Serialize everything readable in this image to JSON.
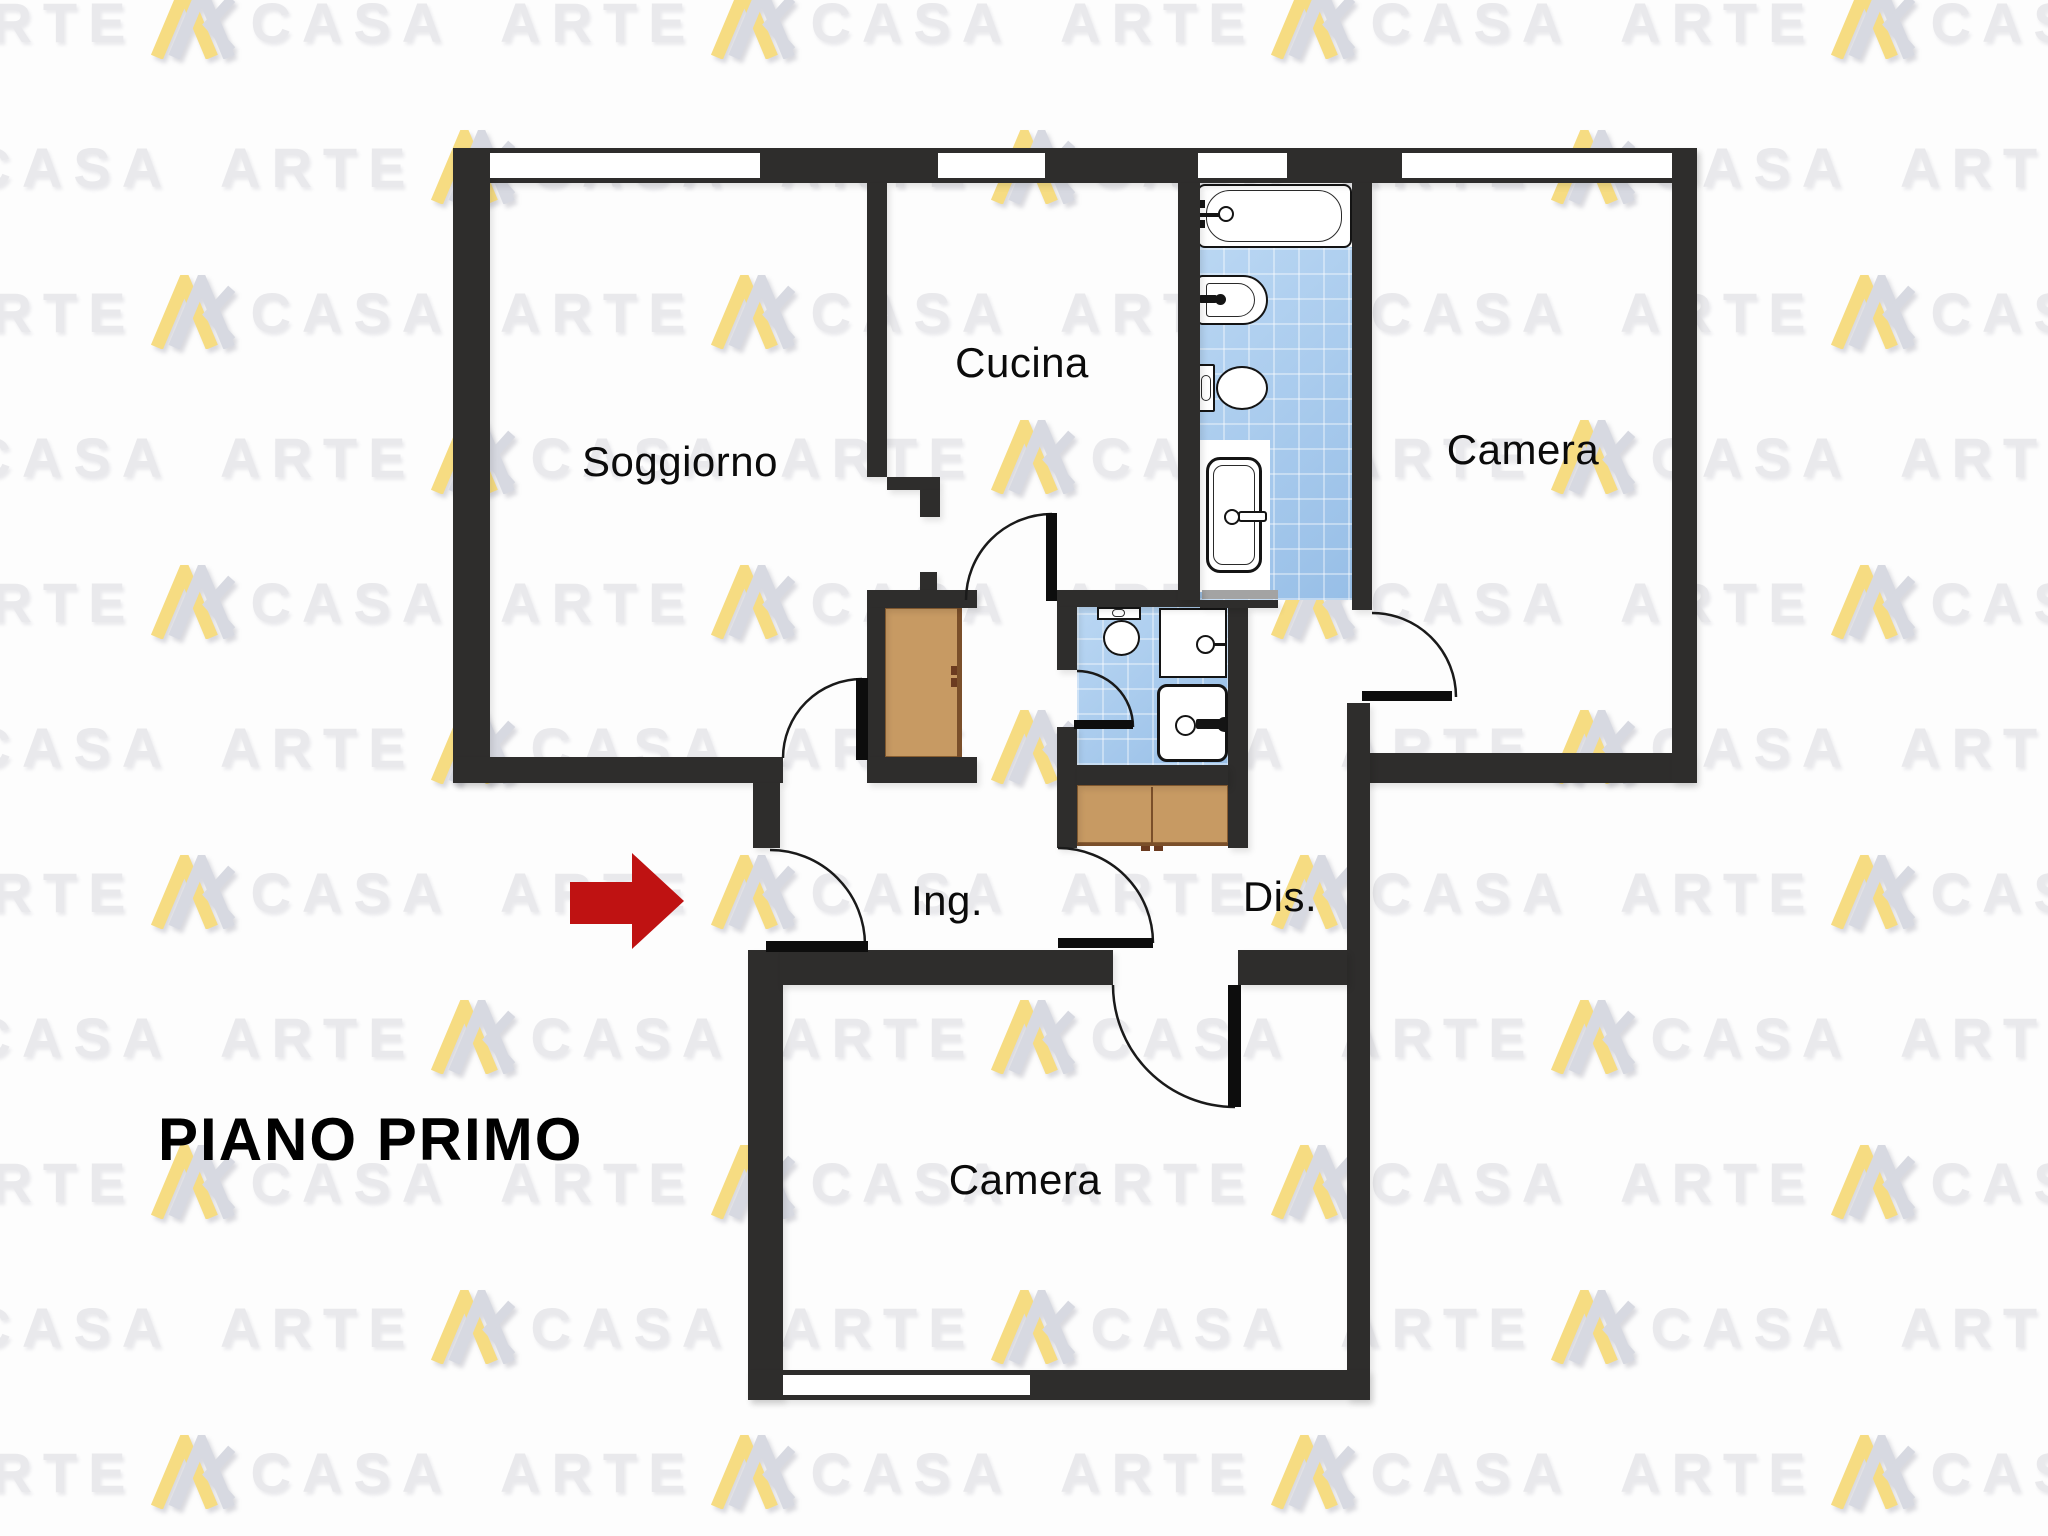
{
  "page": {
    "title": "PIANO PRIMO"
  },
  "watermark": {
    "word_left": "ARTE",
    "word_right": "CASA",
    "row_step": 145,
    "col_step": 560,
    "stagger": 280,
    "row_start": -15,
    "col_start": -60,
    "rows": 11,
    "cols": 5,
    "text_color": "#e9e9ec",
    "logo_yellow": "#f6dc82",
    "logo_gray": "#d7d9e1"
  },
  "colors": {
    "wall": "#2e2d2c",
    "floor": "#fdfdfd",
    "tile_blue": "#a9cdf0",
    "furniture_brown": "#c79a63",
    "furniture_edge": "#7a4f2a",
    "arrow_red": "#bf1212",
    "door_stroke": "#1a1a1a",
    "threshold_gray": "#a3a3a3",
    "label": "#0b0b0b"
  },
  "rooms": [
    {
      "id": "soggiorno",
      "label": "Soggiorno",
      "cx": 680,
      "cy": 462
    },
    {
      "id": "cucina",
      "label": "Cucina",
      "cx": 1022,
      "cy": 363
    },
    {
      "id": "camera-nord",
      "label": "Camera",
      "cx": 1523,
      "cy": 450
    },
    {
      "id": "ingresso",
      "label": "Ing.",
      "cx": 947,
      "cy": 901
    },
    {
      "id": "disimpegno",
      "label": "Dis.",
      "cx": 1280,
      "cy": 897
    },
    {
      "id": "camera-sud",
      "label": "Camera",
      "cx": 1025,
      "cy": 1180
    }
  ],
  "plan": {
    "canvas": {
      "w": 2048,
      "h": 1536
    },
    "walls": [
      [
        453,
        148,
        1244,
        35
      ],
      [
        453,
        148,
        37,
        635
      ],
      [
        453,
        757,
        330,
        26
      ],
      [
        867,
        183,
        20,
        294
      ],
      [
        887,
        477,
        53,
        13
      ],
      [
        920,
        490,
        20,
        27
      ],
      [
        920,
        572,
        17,
        18
      ],
      [
        867,
        590,
        110,
        18
      ],
      [
        867,
        608,
        18,
        149
      ],
      [
        867,
        757,
        110,
        26
      ],
      [
        1057,
        590,
        143,
        17
      ],
      [
        1057,
        607,
        20,
        63
      ],
      [
        1057,
        727,
        20,
        121
      ],
      [
        1228,
        607,
        20,
        241
      ],
      [
        1077,
        765,
        151,
        20
      ],
      [
        1178,
        183,
        22,
        417
      ],
      [
        1200,
        600,
        78,
        8
      ],
      [
        1352,
        183,
        20,
        427
      ],
      [
        1352,
        753,
        341,
        30
      ],
      [
        1672,
        148,
        25,
        635
      ],
      [
        1347,
        703,
        23,
        697
      ],
      [
        753,
        783,
        27,
        65
      ],
      [
        748,
        950,
        35,
        450
      ],
      [
        780,
        950,
        333,
        35
      ],
      [
        1238,
        950,
        109,
        35
      ],
      [
        748,
        1370,
        622,
        30
      ]
    ],
    "windows": [
      [
        490,
        153,
        270,
        25
      ],
      [
        938,
        153,
        107,
        25
      ],
      [
        1198,
        153,
        89,
        25
      ],
      [
        1402,
        153,
        270,
        25
      ],
      [
        783,
        1375,
        247,
        20
      ]
    ],
    "shapes": [
      {
        "n": "bath-tiles",
        "c": "tile",
        "r": [
          1198,
          247,
          154,
          353
        ]
      },
      {
        "n": "wc-tiles",
        "c": "tile",
        "r": [
          1077,
          607,
          151,
          158
        ]
      },
      {
        "n": "shower-area",
        "c": "patch",
        "r": [
          1198,
          440,
          72,
          152
        ]
      },
      {
        "n": "bathtub",
        "c": "box",
        "r": [
          1197,
          184,
          155,
          64
        ],
        "br": "8px",
        "bw": 2.5
      },
      {
        "n": "bathtub-inner",
        "c": "obox",
        "r": [
          1206,
          190,
          136,
          52
        ],
        "br": "24px",
        "bw": 1.5
      },
      {
        "n": "bathtub-tap",
        "c": "bar",
        "r": [
          1199,
          213,
          22,
          4
        ]
      },
      {
        "n": "bathtub-knob",
        "c": "ring",
        "r": [
          1218,
          206,
          16,
          16
        ],
        "bw": 2
      },
      {
        "n": "bathtub-valve-a",
        "c": "bar",
        "r": [
          1197,
          200,
          8,
          8
        ]
      },
      {
        "n": "bathtub-valve-b",
        "c": "bar",
        "r": [
          1197,
          220,
          8,
          8
        ]
      },
      {
        "n": "bidet",
        "c": "box",
        "r": [
          1197,
          275,
          71,
          50
        ],
        "br": "6px 28px 28px 6px",
        "bw": 2.5
      },
      {
        "n": "bidet-inner",
        "c": "obox",
        "r": [
          1206,
          283,
          49,
          34
        ],
        "br": "4px 20px 20px 4px",
        "bw": 1.5
      },
      {
        "n": "bidet-tap",
        "c": "bar",
        "r": [
          1199,
          295,
          18,
          8
        ],
        "br": "2px"
      },
      {
        "n": "bidet-dot",
        "c": "dot",
        "r": [
          1215,
          294,
          11,
          11
        ]
      },
      {
        "n": "toilet-tank",
        "c": "box",
        "r": [
          1198,
          364,
          17,
          48
        ],
        "br": "2px",
        "bw": 2
      },
      {
        "n": "toilet-tank-in",
        "c": "obox",
        "r": [
          1201,
          375,
          10,
          26
        ],
        "br": "5px",
        "bw": 1.2
      },
      {
        "n": "toilet-bowl",
        "c": "box",
        "r": [
          1216,
          366,
          52,
          44
        ],
        "br": "50%",
        "bw": 2.5
      },
      {
        "n": "shower",
        "c": "box",
        "r": [
          1206,
          457,
          56,
          116
        ],
        "br": "14px",
        "bw": 3
      },
      {
        "n": "shower-inner",
        "c": "obox",
        "r": [
          1213,
          465,
          42,
          100
        ],
        "br": "10px",
        "bw": 1.5
      },
      {
        "n": "shower-knob",
        "c": "ring",
        "r": [
          1224,
          509,
          16,
          16
        ],
        "bw": 2.5
      },
      {
        "n": "shower-handle",
        "c": "box",
        "r": [
          1238,
          511,
          29,
          11
        ],
        "br": "3px",
        "bw": 2
      },
      {
        "n": "wc-toilet-tank",
        "c": "box",
        "r": [
          1097,
          607,
          44,
          13
        ],
        "bw": 2
      },
      {
        "n": "wc-toilet-knob",
        "c": "obox",
        "r": [
          1112,
          609,
          13,
          8
        ],
        "br": "4px",
        "bw": 1.2
      },
      {
        "n": "wc-toilet-bowl",
        "c": "box",
        "r": [
          1103,
          620,
          37,
          36
        ],
        "br": "50%",
        "bw": 2.5
      },
      {
        "n": "washbasin",
        "c": "box",
        "r": [
          1159,
          608,
          68,
          70
        ],
        "bw": 2.5
      },
      {
        "n": "washbasin-ring",
        "c": "ring",
        "r": [
          1196,
          635,
          19,
          19
        ],
        "bw": 2
      },
      {
        "n": "washbasin-line",
        "c": "bar",
        "r": [
          1214,
          643,
          13,
          3
        ]
      },
      {
        "n": "laundry-sink",
        "c": "box",
        "r": [
          1157,
          684,
          71,
          78
        ],
        "br": "10px",
        "bw": 3
      },
      {
        "n": "laundry-ring",
        "c": "ring",
        "r": [
          1175,
          715,
          21,
          21
        ],
        "bw": 2.5
      },
      {
        "n": "laundry-bar",
        "c": "bar",
        "r": [
          1196,
          719,
          25,
          10
        ],
        "br": "2px"
      },
      {
        "n": "laundry-dot",
        "c": "dot",
        "r": [
          1217,
          717,
          15,
          15
        ]
      },
      {
        "n": "wardrobe",
        "c": "brown",
        "r": [
          885,
          608,
          77,
          149
        ]
      },
      {
        "n": "wardrobe-front",
        "c": "edge",
        "r": [
          957,
          608,
          5,
          149
        ]
      },
      {
        "n": "wardrobe-handle-a",
        "c": "handle",
        "r": [
          951,
          666,
          6,
          9
        ]
      },
      {
        "n": "wardrobe-handle-b",
        "c": "handle",
        "r": [
          951,
          678,
          6,
          9
        ]
      },
      {
        "n": "cabinet",
        "c": "brown",
        "r": [
          1077,
          785,
          151,
          58
        ]
      },
      {
        "n": "cabinet-front",
        "c": "edge",
        "r": [
          1077,
          843,
          151,
          3
        ]
      },
      {
        "n": "cabinet-divider",
        "c": "edge",
        "r": [
          1151,
          787,
          2,
          56
        ]
      },
      {
        "n": "cabinet-handle-a",
        "c": "handle",
        "r": [
          1141,
          846,
          9,
          5
        ]
      },
      {
        "n": "cabinet-handle-b",
        "c": "handle",
        "r": [
          1154,
          846,
          9,
          5
        ]
      },
      {
        "n": "sliding-door",
        "c": "gray",
        "r": [
          1202,
          590,
          76,
          9
        ]
      }
    ],
    "doors": [
      {
        "name": "soggiorno-door",
        "arc": "M862,679 A79,79 0 0 0 783,758",
        "leaf": [
          856,
          678,
          12,
          82
        ]
      },
      {
        "name": "cucina-door",
        "arc": "M1052,514 A86,86 0 0 0 966,600",
        "leaf": [
          1046,
          513,
          11,
          88
        ]
      },
      {
        "name": "entrance-door",
        "arc": "M770,850 A95,95 0 0 1 865,945",
        "leaf": [
          766,
          941,
          102,
          11
        ]
      },
      {
        "name": "wc-door",
        "arc": "M1077,671 A56,56 0 0 1 1133,727",
        "leaf": [
          1074,
          720,
          59,
          9
        ]
      },
      {
        "name": "disimpegno-door",
        "arc": "M1058,848 A95,95 0 0 1 1153,943",
        "leaf": [
          1058,
          938,
          95,
          10
        ]
      },
      {
        "name": "camera-sud-door",
        "arc": "M1113,985 A122,122 0 0 0 1235,1107",
        "leaf": [
          1228,
          985,
          13,
          122
        ]
      },
      {
        "name": "camera-nord-door",
        "arc": "M1372,613 A84,84 0 0 1 1456,697",
        "leaf": [
          1362,
          691,
          90,
          10
        ]
      }
    ],
    "arrow": {
      "shaft": [
        570,
        882,
        62,
        42
      ],
      "tip_x": 632,
      "tip_y": 853
    }
  }
}
